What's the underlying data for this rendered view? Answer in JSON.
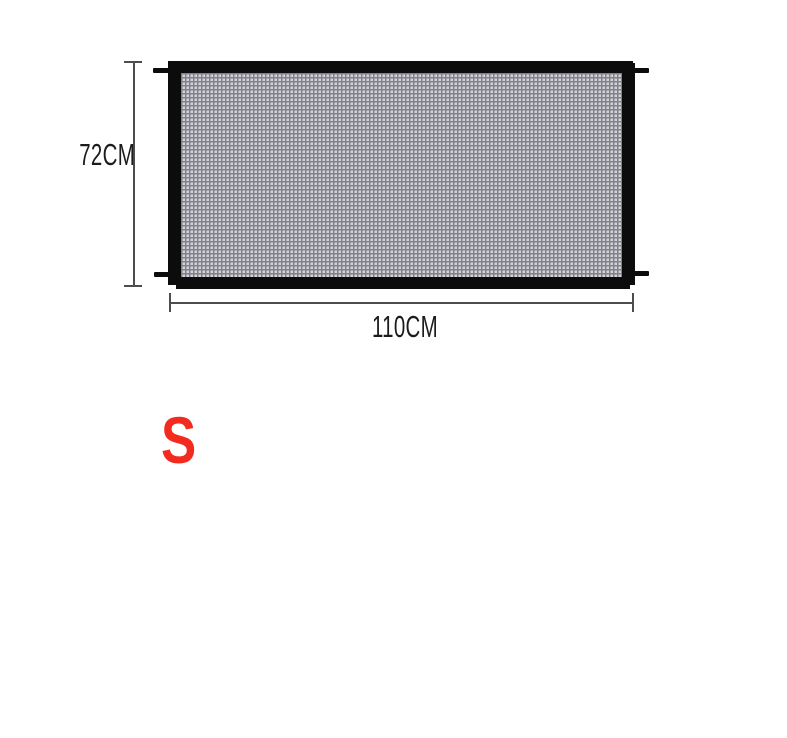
{
  "diagram": {
    "height_label": "72CM",
    "width_label": "110CM",
    "size_label": "S"
  },
  "colors": {
    "background": "#ffffff",
    "frame_black": "#0c0c0c",
    "mesh_light": "#d3d3d8",
    "mesh_grid": "#81818b",
    "dimension_line": "#4d4d4d",
    "dimension_text": "#1c1c1c",
    "size_red": "#f32b1e"
  }
}
